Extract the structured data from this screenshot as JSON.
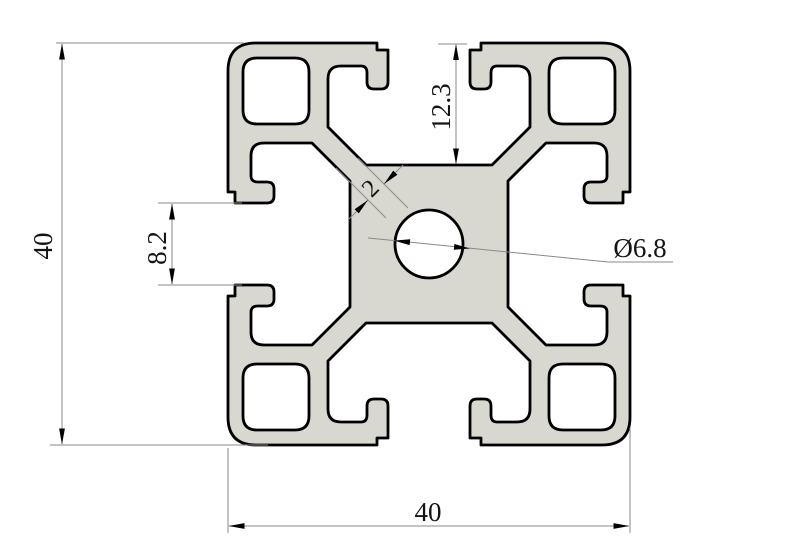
{
  "drawing": {
    "type": "technical-cross-section",
    "subject": "40x40 T-slot aluminum extrusion profile",
    "dimensions": {
      "overall_height": "40",
      "overall_width": "40",
      "slot_depth": "12.3",
      "slot_opening": "8.2",
      "web_thickness": "2",
      "center_hole_diameter": "Ø6.8"
    },
    "colors": {
      "profile_fill": "#d8d8d0",
      "profile_outline": "#000000",
      "dimension_line": "#8a8a8a",
      "dimension_text": "#141414",
      "background": "#ffffff"
    }
  }
}
